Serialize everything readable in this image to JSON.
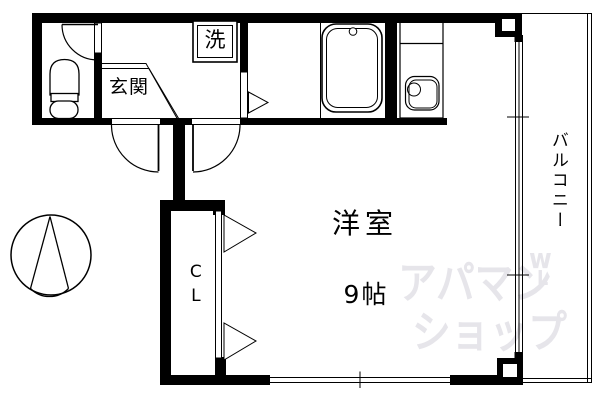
{
  "plan": {
    "entrance_label": "玄関",
    "washer_label": "洗",
    "room_label": "洋室",
    "room_size": "9帖",
    "closet_label": "CL",
    "balcony_label": "バルコニー"
  },
  "watermark": {
    "line1": "アパマン",
    "line2": "ショップ",
    "mark_top": "w",
    "mark_bottom": "L"
  },
  "icons": {
    "compass": "north-arrow-in-circle",
    "toilet": "toilet-top-view",
    "bathtub": "rounded-rect-tub-with-drain",
    "kitchen_sink": "counter-with-sink-and-faucet-circle",
    "washing_machine": "double-border-box-with-wash-kanji",
    "swing_doors": "quarter-arc-door-swings",
    "folding_doors": "triangle-fold-markers",
    "windows": "double-line-glazing-with-ticks"
  },
  "colors": {
    "wall": "#000000",
    "background": "#ffffff",
    "watermark": "#e6e5ea"
  }
}
